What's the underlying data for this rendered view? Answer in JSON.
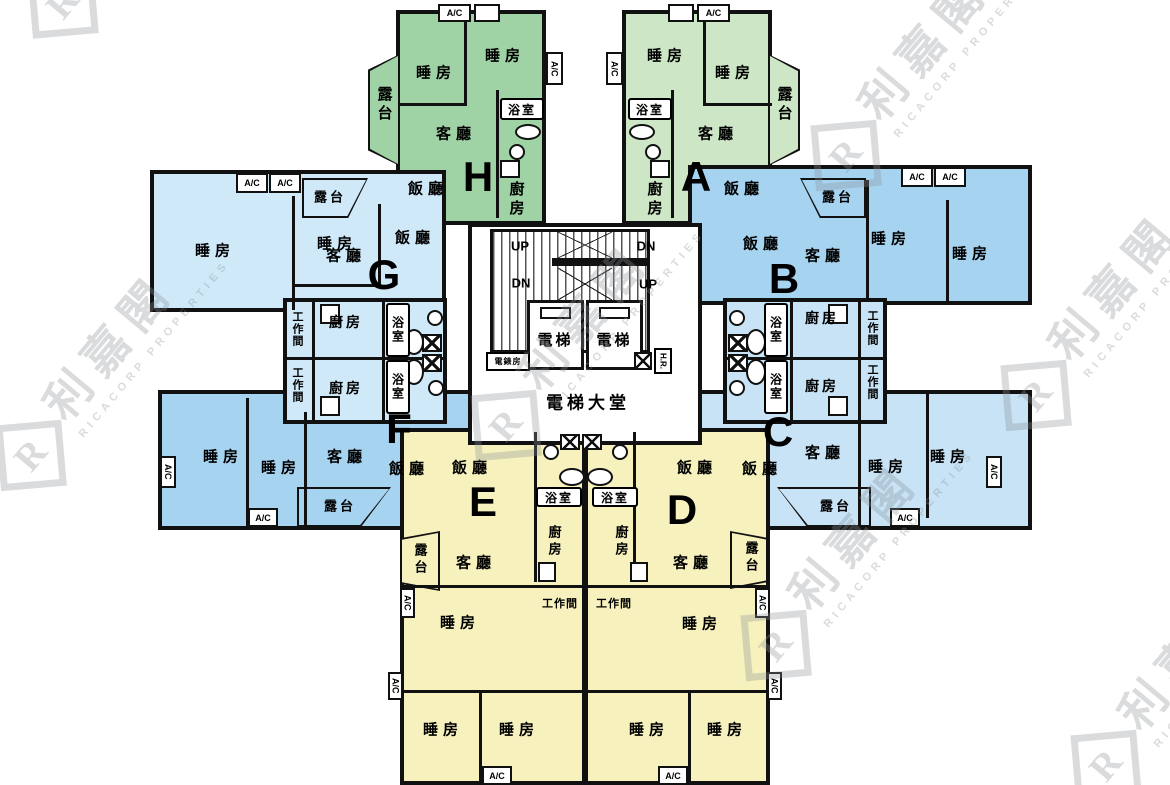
{
  "plan": {
    "watermark": {
      "logo_letter": "R",
      "brand_cjk": "利嘉閣",
      "brand_latin": "RICACORP PROPERTIES"
    },
    "core": {
      "up": "UP",
      "down": "DN",
      "lift": "電梯",
      "meter_room": "電錶房",
      "hose_reel": "H.R.",
      "lobby": "電梯大堂"
    },
    "labels": {
      "bedroom": "睡房",
      "living_room": "客廳",
      "dining_room": "飯廳",
      "kitchen": "廚房",
      "bathroom": "浴室",
      "balcony": "露台",
      "utility": "工作間",
      "ac": "A/C"
    },
    "units": [
      {
        "id": "A",
        "color": "#cde7c6"
      },
      {
        "id": "B",
        "color": "#a6d3f0"
      },
      {
        "id": "C",
        "color": "#c7e3f5"
      },
      {
        "id": "D",
        "color": "#f6f1bd"
      },
      {
        "id": "E",
        "color": "#f6f1bd"
      },
      {
        "id": "F",
        "color": "#a6d3f0"
      },
      {
        "id": "G",
        "color": "#cfe9f9"
      },
      {
        "id": "H",
        "color": "#9fd2a5"
      }
    ],
    "wall_color": "#111111"
  }
}
